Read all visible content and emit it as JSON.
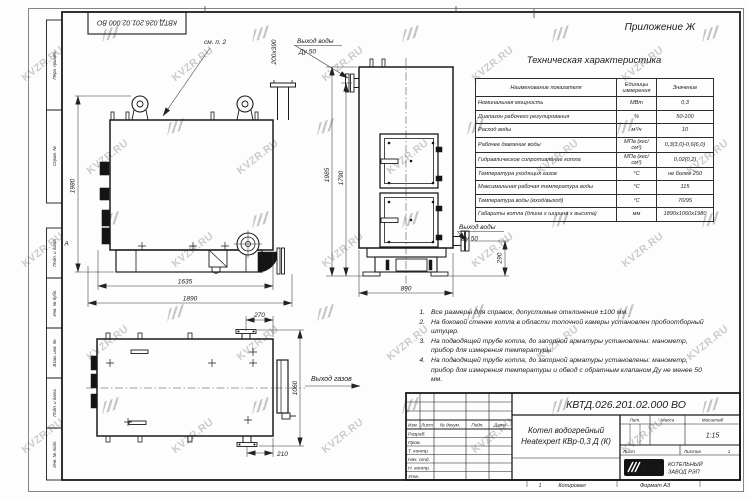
{
  "watermark": {
    "text": "KVZR.RU"
  },
  "frame": {
    "zone_letter": "А",
    "margin_labels": [
      "Перв. примен.",
      "Справ. №",
      "Подп. и дата",
      "Инв. № дубл.",
      "Взам. инв. №",
      "Подп. и дата",
      "Инв. № подл."
    ]
  },
  "appendix": "Приложение Ж",
  "spec_table": {
    "title": "Техническая характеристика",
    "columns": [
      "Наименование показателя",
      "Единицы измерения",
      "Значение"
    ],
    "rows": [
      [
        "Номинальная мощность",
        "МВт",
        "0,3"
      ],
      [
        "Диапазон рабочего регулирования",
        "%",
        "50-100"
      ],
      [
        "Расход воды",
        "м³/ч",
        "10"
      ],
      [
        "Рабочее давление воды",
        "МПа (кгс/см²)",
        "0,3(3,0)-0,6(6,0)"
      ],
      [
        "Гидравлическое сопротивление котла",
        "МПа (кгс/см²)",
        "0,02(0,2)"
      ],
      [
        "Температура уходящих газов",
        "°С",
        "не более 250"
      ],
      [
        "Максимальная рабочая температура воды",
        "°С",
        "115"
      ],
      [
        "Температура воды (вход/выход)",
        "°С",
        "70/95"
      ],
      [
        "Габариты котла (длина х ширина х высота)",
        "мм",
        "1890х1060х1980"
      ]
    ]
  },
  "notes": [
    "Все размеры для справок, допустимые отклонения ±100 мм.",
    "На боковой стенке котла в области топочной камеры установлен пробоотборный штуцер.",
    "На подводящей трубе котла, до запорной арматуры установлены: манометр, прибор для измерения температуры.",
    "На подводящей трубе котла, до запорной арматуры установлены: манометр, прибор для измерения температуры и обвод с обратным клапаном Ду не менее 50 мм."
  ],
  "drawing": {
    "see_note": "см. п. 2",
    "outlet_size": "200х390",
    "water_outlet_label": "Выход воды",
    "water_outlet_dn": "Ду 50",
    "water_outlet2_label": "Выход воды",
    "water_outlet2_dn": "Ду 50",
    "gas_outlet_label": "Выход газов",
    "dims": {
      "v1_height": "1980",
      "v1_base": "1635",
      "v1_total": "1890",
      "v2_h_outer": "1985",
      "v2_h_inner": "1790",
      "v2_width": "890",
      "v2_flange": "290",
      "v3_top": "270",
      "v3_depth": "1060",
      "v3_bottom": "210"
    }
  },
  "title_block": {
    "doc_number": "КВТД.026.201.02.000 ВО",
    "title_line1": "Котел водогрейный",
    "title_line2": "Heatexpert КВр-0,3 Д (К)",
    "header_cells": [
      "Изм.",
      "Лист",
      "№ докум.",
      "Подп.",
      "Дата"
    ],
    "row_labels": [
      "Разраб.",
      "Пров.",
      "Т. контр.",
      "Нач. отд.",
      "Н. контр.",
      "Утв."
    ],
    "lit_label": "Лит.",
    "mass_label": "Масса",
    "scale_label": "Масштаб",
    "scale_value": "1:15",
    "sheet_label": "Лист",
    "sheets_label": "Листов",
    "sheets_value": "1",
    "company_abbr": "KVZR",
    "company_line1": "КОТЕЛЬНЫЙ",
    "company_line2": "ЗАВОД РЭП",
    "footer_num": "1",
    "copied_label": "Копировал",
    "format_label": "Формат А3"
  }
}
